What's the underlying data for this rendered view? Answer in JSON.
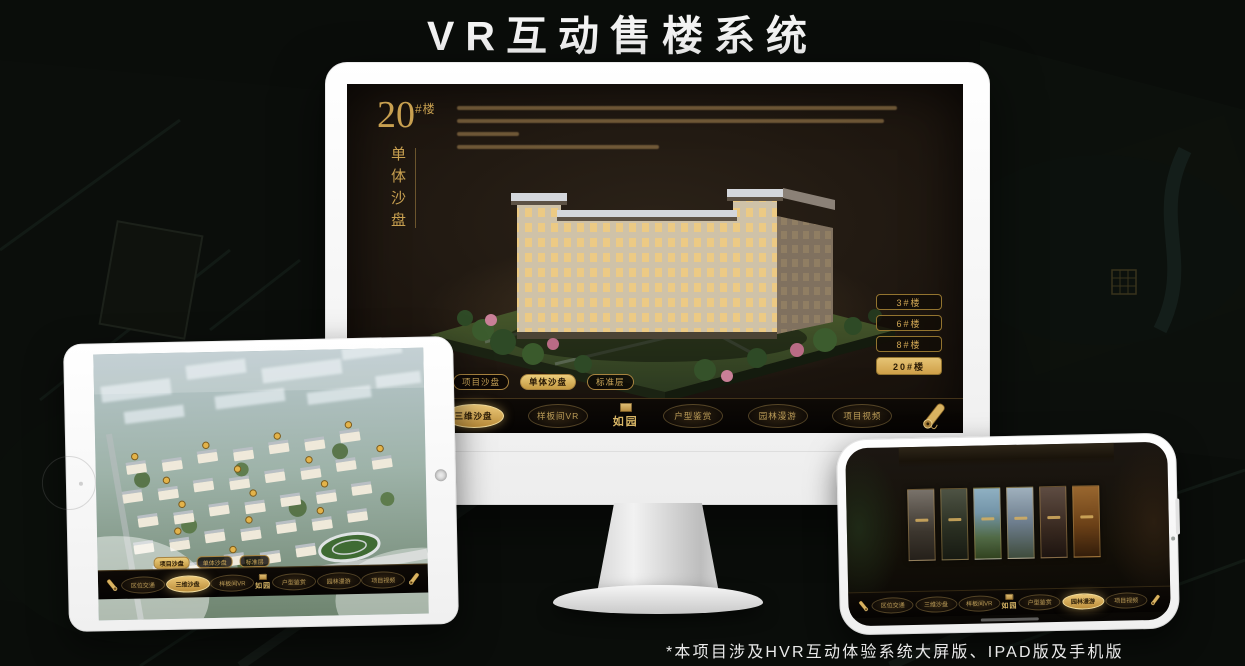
{
  "page": {
    "title": "VR互动售楼系统",
    "footnote": "*本项目涉及HVR互动体验系统大屏版、IPAD版及手机版"
  },
  "colors": {
    "gold": "#c9a45c",
    "gold_active": "#d9b35f",
    "screen_bg": "#1a130d",
    "nav_bg": "#0a0705",
    "frame_white": "#f5f5f5"
  },
  "monitor": {
    "headline": {
      "number": "20",
      "suffix": "#楼",
      "subtitle": "单体沙盘"
    },
    "floor_buttons": [
      {
        "label": "3#楼",
        "active": false
      },
      {
        "label": "6#楼",
        "active": false
      },
      {
        "label": "8#楼",
        "active": false
      },
      {
        "label": "20#楼",
        "active": true
      }
    ],
    "view_tabs": [
      {
        "label": "项目沙盘",
        "active": false
      },
      {
        "label": "单体沙盘",
        "active": true
      },
      {
        "label": "标准层",
        "active": false
      }
    ],
    "nav": {
      "logo": "如园",
      "items": [
        {
          "label": "区位交通",
          "active": false
        },
        {
          "label": "三维沙盘",
          "active": true
        },
        {
          "label": "样板间VR",
          "active": false
        },
        {
          "label": "户型鉴赏",
          "active": false
        },
        {
          "label": "园林漫游",
          "active": false
        },
        {
          "label": "项目视频",
          "active": false
        }
      ]
    }
  },
  "tablet": {
    "view_tabs": [
      {
        "label": "项目沙盘",
        "active": true
      },
      {
        "label": "单体沙盘",
        "active": false
      },
      {
        "label": "标准层",
        "active": false
      }
    ],
    "nav": {
      "logo": "如园",
      "items": [
        {
          "label": "区位交通",
          "active": false
        },
        {
          "label": "三维沙盘",
          "active": true
        },
        {
          "label": "样板间VR",
          "active": false
        },
        {
          "label": "户型鉴赏",
          "active": false
        },
        {
          "label": "园林漫游",
          "active": false
        },
        {
          "label": "项目视频",
          "active": false
        }
      ]
    }
  },
  "phone": {
    "nav": {
      "logo": "如园",
      "items": [
        {
          "label": "区位交通",
          "active": false
        },
        {
          "label": "三维沙盘",
          "active": false
        },
        {
          "label": "样板间VR",
          "active": false
        },
        {
          "label": "户型鉴赏",
          "active": false
        },
        {
          "label": "园林漫游",
          "active": true
        },
        {
          "label": "项目视频",
          "active": false
        }
      ]
    }
  }
}
